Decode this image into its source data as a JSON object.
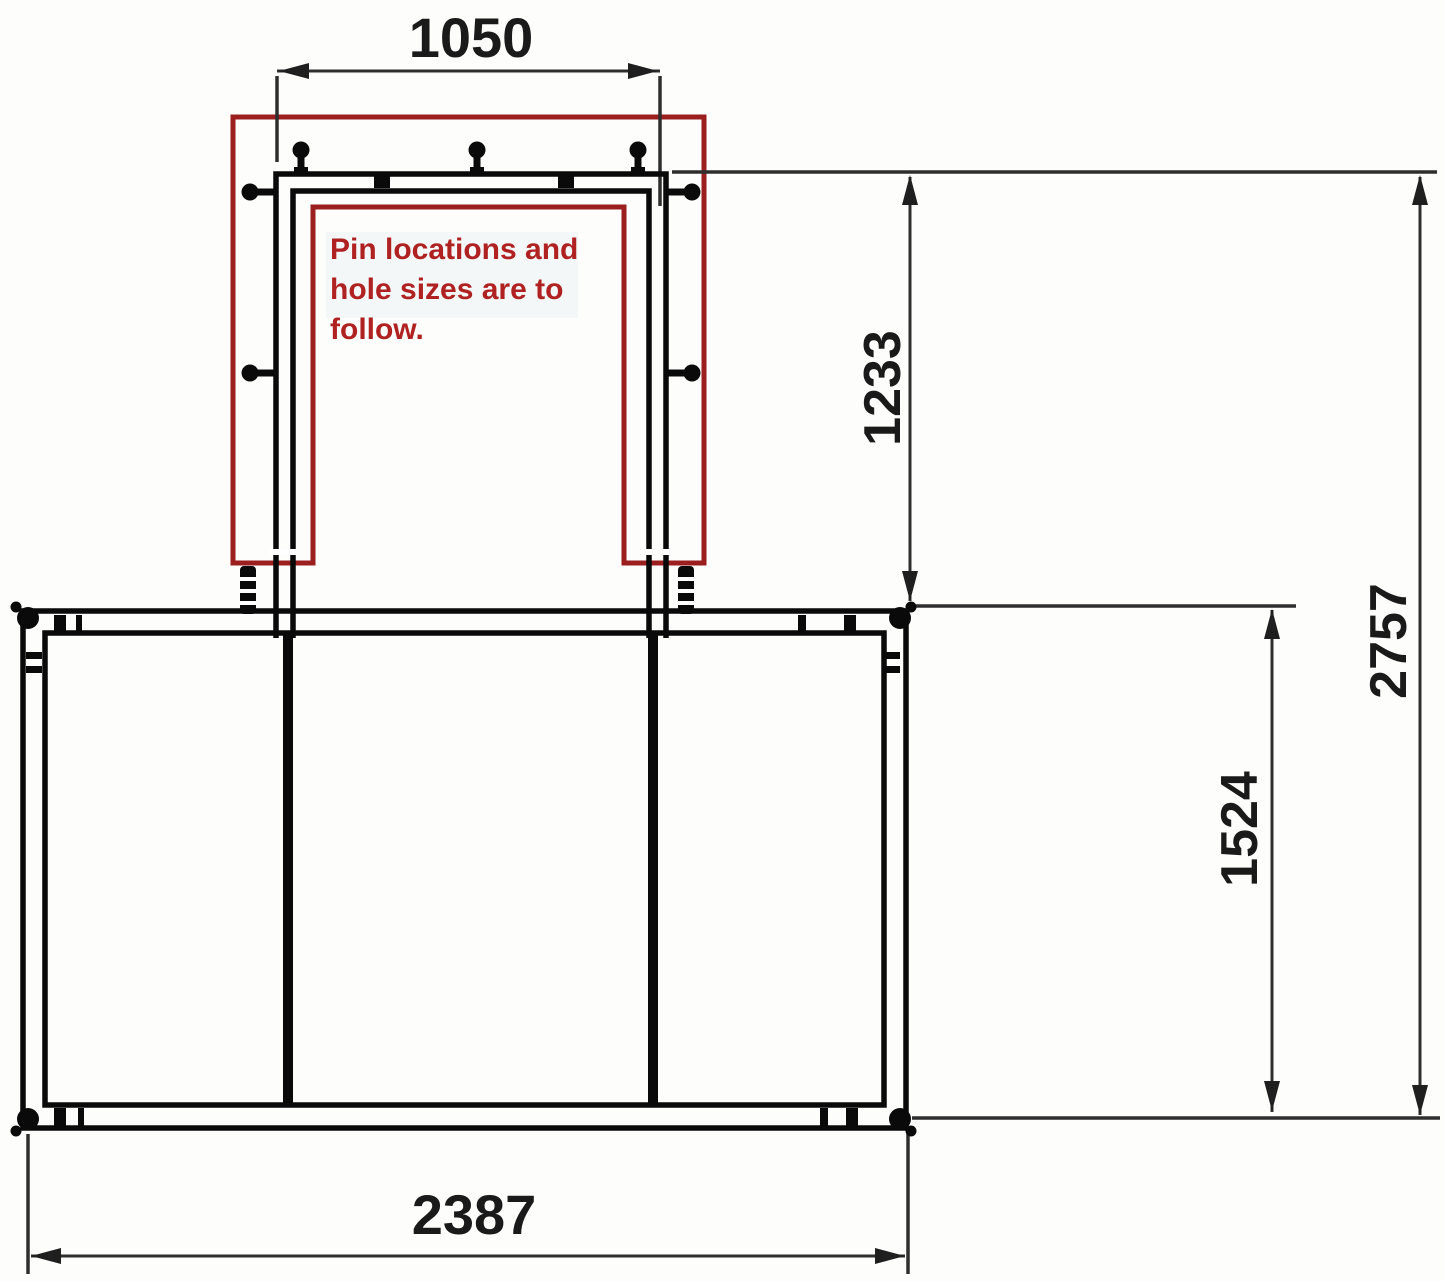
{
  "drawing": {
    "type": "technical-dimension-drawing",
    "note": {
      "lines": [
        "Pin locations and",
        "hole sizes are to",
        "follow."
      ]
    },
    "dimensions": {
      "gate_outer_width": "1050",
      "gate_height_above_frame": "1233",
      "overall_height": "2757",
      "main_frame_height": "1524",
      "main_frame_width": "2387"
    },
    "colors": {
      "annotation_red": "#9c1f1f",
      "note_text_red": "#b02222",
      "frame_black": "#0a0a0a",
      "dimension_gray": "#2e2e2e",
      "text_black": "#1a1a1a"
    }
  }
}
